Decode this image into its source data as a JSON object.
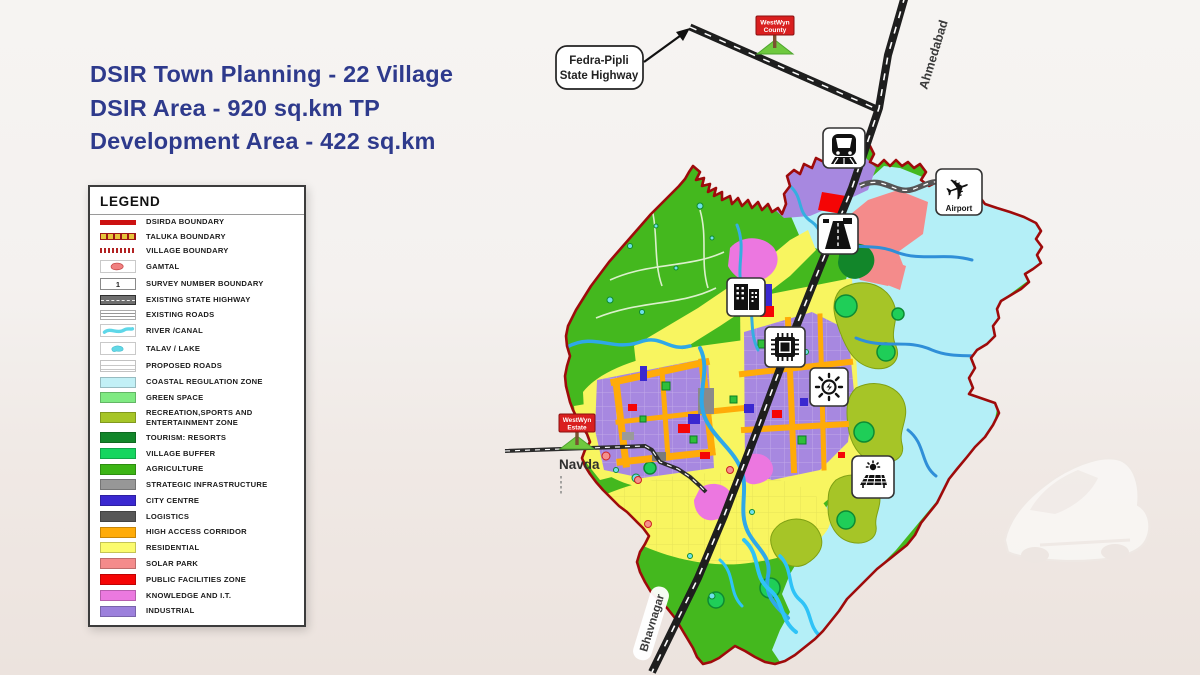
{
  "title": {
    "line1": "DSIR Town Planning - 22 Village",
    "line2": "DSIR Area - 920 sq.km TP",
    "line3": "Development Area - 422 sq.km",
    "color": "#2E3A8C"
  },
  "legend": {
    "heading": "LEGEND",
    "items": [
      {
        "label": "DSIRDA BOUNDARY",
        "swatch": "dsirda-line",
        "color": "#CC1111"
      },
      {
        "label": "TALUKA BOUNDARY",
        "swatch": "taluka-dash",
        "color": "#E7C43C"
      },
      {
        "label": "VILLAGE BOUNDARY",
        "swatch": "village-dash",
        "color": "#B22222"
      },
      {
        "label": "GAMTAL",
        "swatch": "gamtal-blob",
        "color": "#F08080"
      },
      {
        "label": "SURVEY NUMBER BOUNDARY",
        "swatch": "survey-box",
        "value": "1"
      },
      {
        "label": "EXISTING STATE HIGHWAY",
        "swatch": "state-highway",
        "color": "#6F6F6F"
      },
      {
        "label": "EXISTING ROADS",
        "swatch": "roads",
        "color": "#979797"
      },
      {
        "label": "RIVER /CANAL",
        "swatch": "river",
        "color": "#5ED7E8"
      },
      {
        "label": "TALAV / LAKE",
        "swatch": "lake",
        "color": "#63D8E6"
      },
      {
        "label": "PROPOSED ROADS",
        "swatch": "proposed-roads",
        "color": "#C8C8C8"
      },
      {
        "label": "COASTAL REGULATION ZONE",
        "swatch": "fill",
        "color": "#C2F0F6"
      },
      {
        "label": "GREEN SPACE",
        "swatch": "fill",
        "color": "#7FEA82"
      },
      {
        "label": "RECREATION,SPORTS AND ENTERTAINMENT ZONE",
        "swatch": "fill",
        "color": "#A6C527"
      },
      {
        "label": "TOURISM: RESORTS",
        "swatch": "fill",
        "color": "#12862A"
      },
      {
        "label": "VILLAGE BUFFER",
        "swatch": "fill",
        "color": "#16D55F"
      },
      {
        "label": "AGRICULTURE",
        "swatch": "fill",
        "color": "#3CB515"
      },
      {
        "label": "STRATEGIC INFRASTRUCTURE",
        "swatch": "fill",
        "color": "#979797"
      },
      {
        "label": "CITY CENTRE",
        "swatch": "fill",
        "color": "#3A28D0"
      },
      {
        "label": "LOGISTICS",
        "swatch": "fill",
        "color": "#575757"
      },
      {
        "label": "HIGH ACCESS CORRIDOR",
        "swatch": "fill",
        "color": "#FFAB08"
      },
      {
        "label": "RESIDENTIAL",
        "swatch": "fill",
        "color": "#FBFB6E"
      },
      {
        "label": "SOLAR PARK",
        "swatch": "fill",
        "color": "#F48B8B"
      },
      {
        "label": "PUBLIC FACILITIES ZONE",
        "swatch": "fill",
        "color": "#F50505"
      },
      {
        "label": "KNOWLEDGE AND I.T.",
        "swatch": "fill",
        "color": "#EB79DF"
      },
      {
        "label": "INDUSTRIAL",
        "swatch": "fill",
        "color": "#9C80DC"
      }
    ]
  },
  "map": {
    "callout": {
      "line1": "Fedra-Pipli",
      "line2": "State Highway"
    },
    "signs": {
      "county": {
        "line1": "WestWyn",
        "line2": "County"
      },
      "estate": {
        "line1": "WestWyn",
        "line2": "Estate"
      }
    },
    "labels": {
      "ahmedabad": "Ahmedabad",
      "bhavnagar": "Bhavnagar",
      "navda": "Navda",
      "airport": "Airport"
    },
    "icons": {
      "plane_glyph": "✈"
    },
    "colors": {
      "boundary": "#9E0B0B",
      "highway": "#1E1E1E",
      "river": "#2FA8E8",
      "coastal": "#B4EFF7",
      "agriculture_base": "#44B81E"
    }
  }
}
